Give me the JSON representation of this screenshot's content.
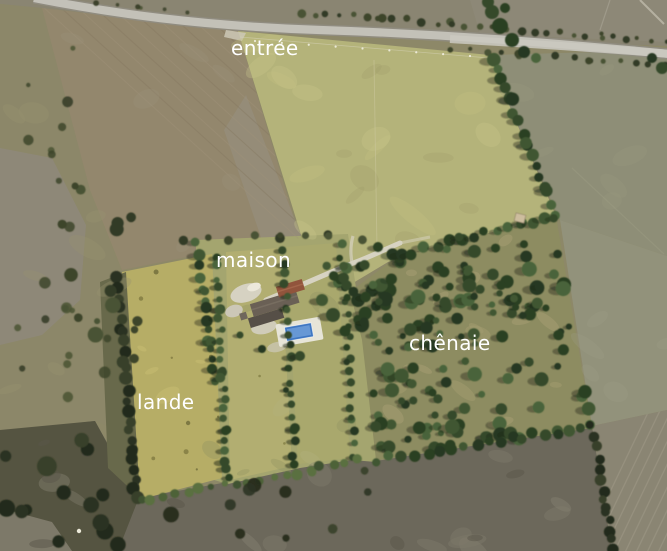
{
  "scene": {
    "type": "annotated aerial photograph of a rural property",
    "labels": {
      "entree": "entrée",
      "maison": "maison",
      "lande": "lande",
      "chenaie": "chênaie"
    },
    "features": [
      "road along top edge",
      "entrance meadow",
      "house with swimming pool",
      "gravel driveway",
      "oak grove",
      "heath strips with hedgerows",
      "plowed fields",
      "vehicles on road"
    ],
    "vehicle_count": 3
  },
  "colors": {
    "label_text": "#ffffff",
    "road": "#c3c1b8",
    "meadow_green": "#b4b37a",
    "heath_yellow": "#b6ad66",
    "grove_ground": "#8d8c61",
    "tree_green": "#34482b",
    "pool_blue": "#3f77c2",
    "pool_deck": "#e7e5d8",
    "roof_dark": "#6a6055",
    "roof_red": "#91543c",
    "plowed_brown": "#93876d",
    "dark_field": "#6c685b"
  }
}
